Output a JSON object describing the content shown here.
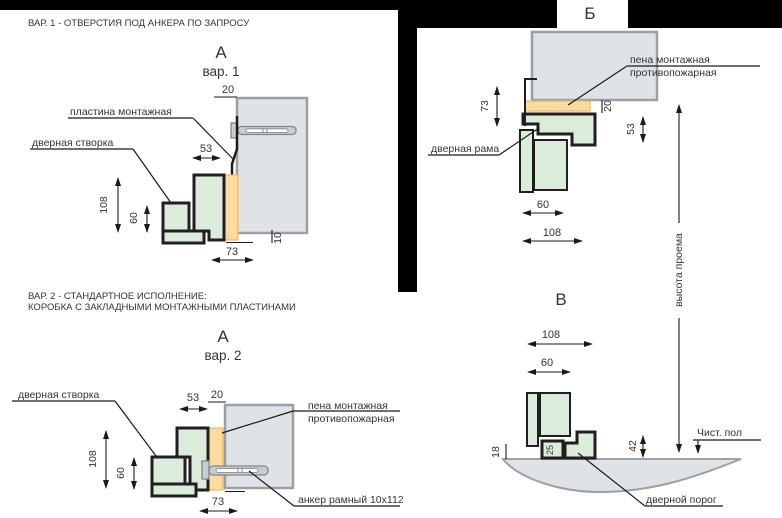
{
  "colors": {
    "accent_green": "#dcecdb",
    "accent_foam": "#fcdc9e",
    "wall_gray": "#e0e3e6",
    "line_black": "#1a1a1a",
    "mask_black": "#000000"
  },
  "var1": {
    "note": "ВАР. 1 - ОТВЕРСТИЯ ПОД АНКЕРА ПО ЗАПРОСУ",
    "view_letter": "А",
    "view_variant": "вар. 1",
    "label_plate": "пластина монтажная",
    "label_leaf": "дверная створка",
    "dim_20": "20",
    "dim_53": "53",
    "dim_108": "108",
    "dim_60": "60",
    "dim_73": "73",
    "dim_10": "10"
  },
  "var2": {
    "note_line1": "ВАР. 2 - СТАНДАРТНОЕ ИСПОЛНЕНИЕ:",
    "note_line2": "КОРОБКА С ЗАКЛАДНЫМИ МОНТАЖНЫМИ ПЛАСТИНАМИ",
    "view_letter": "А",
    "view_variant": "вар. 2",
    "label_leaf": "дверная створка",
    "label_foam_1": "пена монтажная",
    "label_foam_2": "противопожарная",
    "label_anchor": "анкер рамный 10х112",
    "dim_53": "53",
    "dim_20": "20",
    "dim_108": "108",
    "dim_60": "60",
    "dim_73": "73"
  },
  "view_b": {
    "title": "Б",
    "label_foam_1": "пена монтажная",
    "label_foam_2": "противопожарная",
    "label_frame": "дверная рама",
    "label_height": "высота проема",
    "dim_73": "73",
    "dim_20": "20",
    "dim_53": "53",
    "dim_60": "60",
    "dim_108": "108"
  },
  "view_v": {
    "title": "В",
    "dim_108": "108",
    "dim_60": "60",
    "dim_42": "42",
    "dim_25": "25",
    "dim_18": "18",
    "label_floor": "Чист. пол",
    "label_threshold": "дверной порог"
  }
}
